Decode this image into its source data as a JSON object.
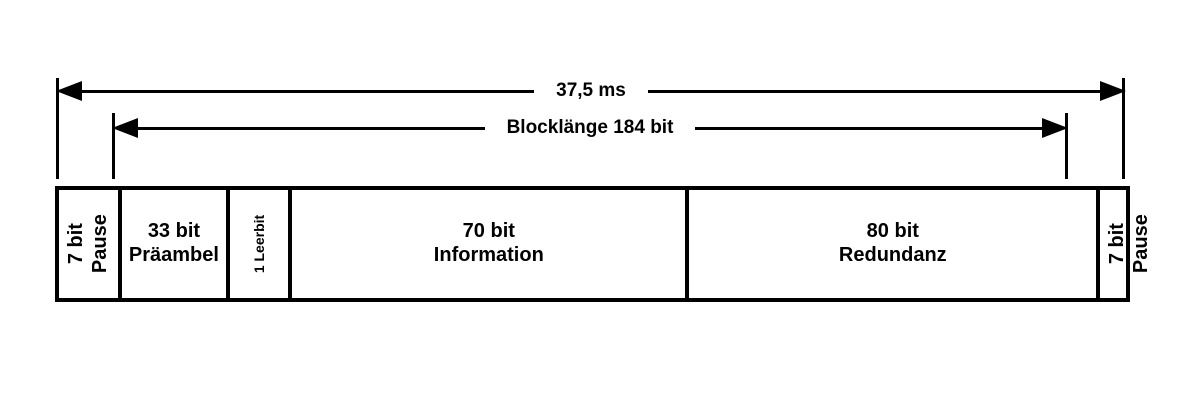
{
  "diagram": {
    "arrows": {
      "outer": {
        "label": "37,5 ms"
      },
      "inner": {
        "label": "Blocklänge 184 bit"
      }
    },
    "segments": [
      {
        "name": "pause-left",
        "line1": "7 bit",
        "line2": "Pause"
      },
      {
        "name": "praeambel",
        "line1": "33 bit",
        "line2": "Präambel"
      },
      {
        "name": "leerbit",
        "line1": "1 Leerbit",
        "line2": ""
      },
      {
        "name": "information",
        "line1": "70 bit",
        "line2": "Information"
      },
      {
        "name": "redundanz",
        "line1": "80 bit",
        "line2": "Redundanz"
      },
      {
        "name": "pause-right",
        "line1": "7 bit",
        "line2": "Pause"
      }
    ],
    "colors": {
      "foreground": "#000000",
      "background": "#ffffff"
    }
  }
}
